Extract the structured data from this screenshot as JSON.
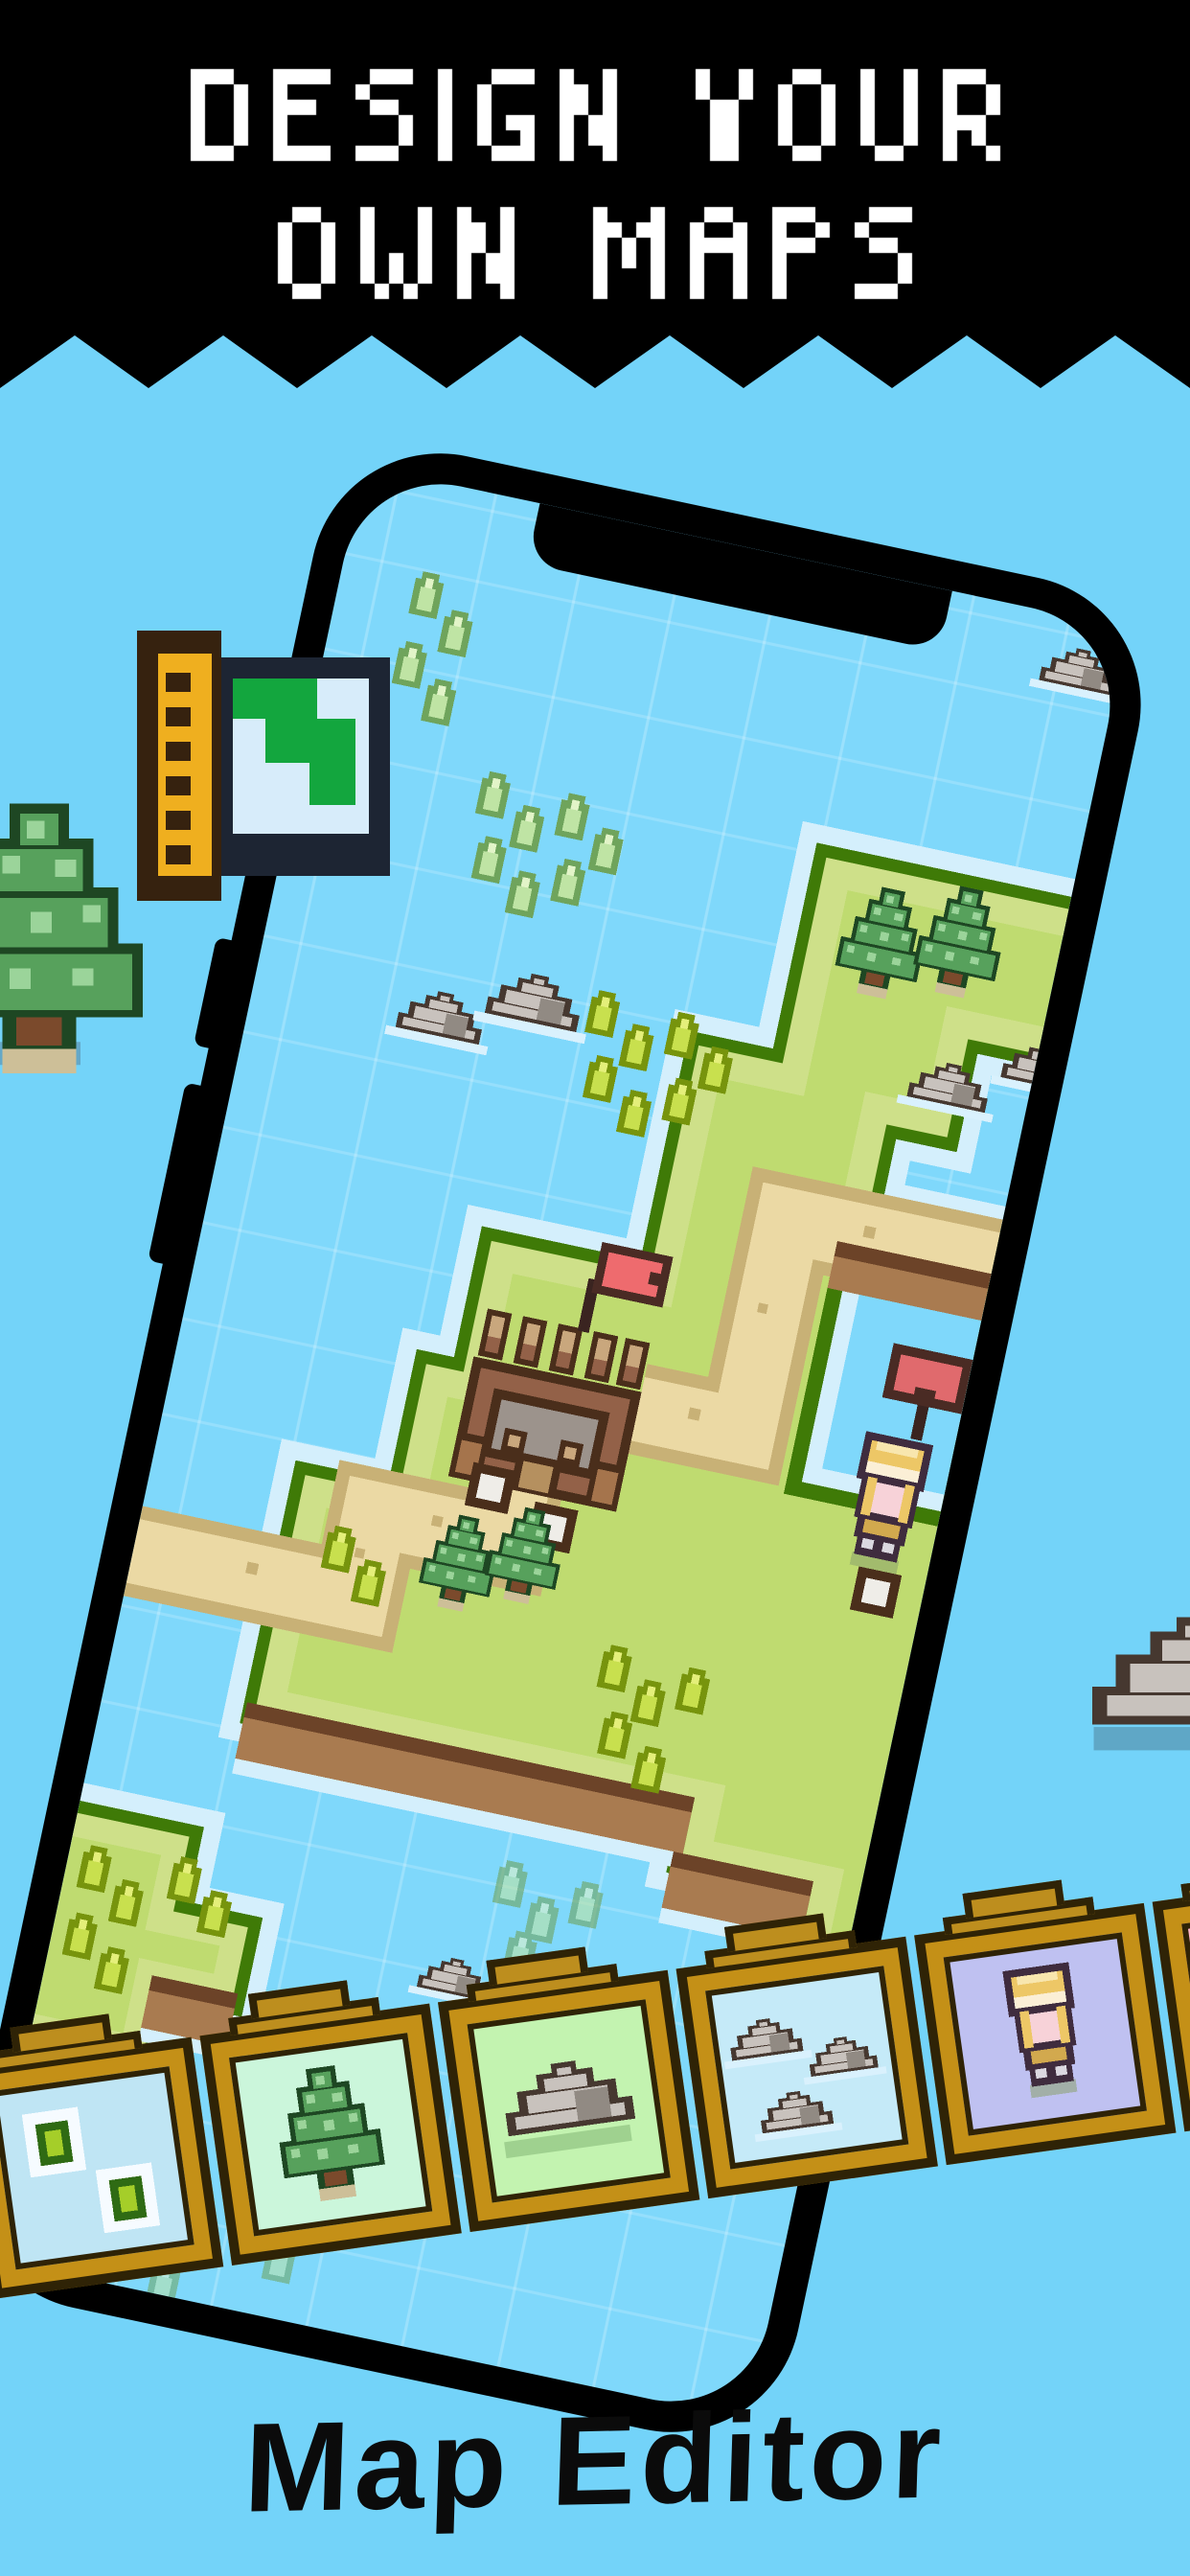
{
  "banner": {
    "line1": "DESIGN YOUR",
    "line2": "OWN MAPS",
    "bg_color": "#000000",
    "text_color": "#FFFFFF"
  },
  "caption": {
    "text": "Map Editor",
    "color": "#0B0B0B"
  },
  "page": {
    "background_color": "#73D3F9"
  },
  "phone": {
    "frame_color": "#000000",
    "screen_water_color": "#7FD8FB"
  },
  "map_icon": {
    "name": "map-with-ruler-icon",
    "wood_color": "#36220F",
    "ruler_color": "#EFAF1F",
    "map_border_color": "#1D2533",
    "map_bg_color": "#D7ECFA",
    "map_green_color": "#13A63E"
  },
  "map_scene": {
    "island_color": "#BFDB70",
    "island_band_color": "#CEE089",
    "island_edge_color": "#3F7A07",
    "water_edge_color": "#D4EFFC",
    "cliff_color": "#A97B50",
    "cliff_line_color": "#6C4328",
    "path_color": "#EBD9A4",
    "path_edge_color": "#C8B176",
    "flag_color": "#EE6B6E",
    "castle": {
      "outline": "#4A2E1B",
      "wall": "#936148",
      "merlon_top": "#C9A77D",
      "courtyard": "#9C938C",
      "gate": "#B5905F"
    },
    "sprites": [
      "castle",
      "red-flag",
      "pond",
      "pond-sign-flag",
      "pine-tree",
      "rock",
      "water-grass-tuft",
      "grass-tuft",
      "character",
      "stone-paver"
    ]
  },
  "palette": {
    "outline_color": "#2F2306",
    "frame_color": "#C49017",
    "tiles": [
      {
        "name": "water-tile",
        "bg": "#BFE5F4"
      },
      {
        "name": "tree-tile",
        "bg": "#CBF6DB"
      },
      {
        "name": "rock-tile",
        "bg": "#C3F3B0"
      },
      {
        "name": "clouds-tile",
        "bg": "#C5EAF8"
      },
      {
        "name": "character-tile",
        "bg": "#BFC1F1"
      },
      {
        "name": "dots-tile",
        "bg": "#FFB5C9"
      }
    ]
  }
}
